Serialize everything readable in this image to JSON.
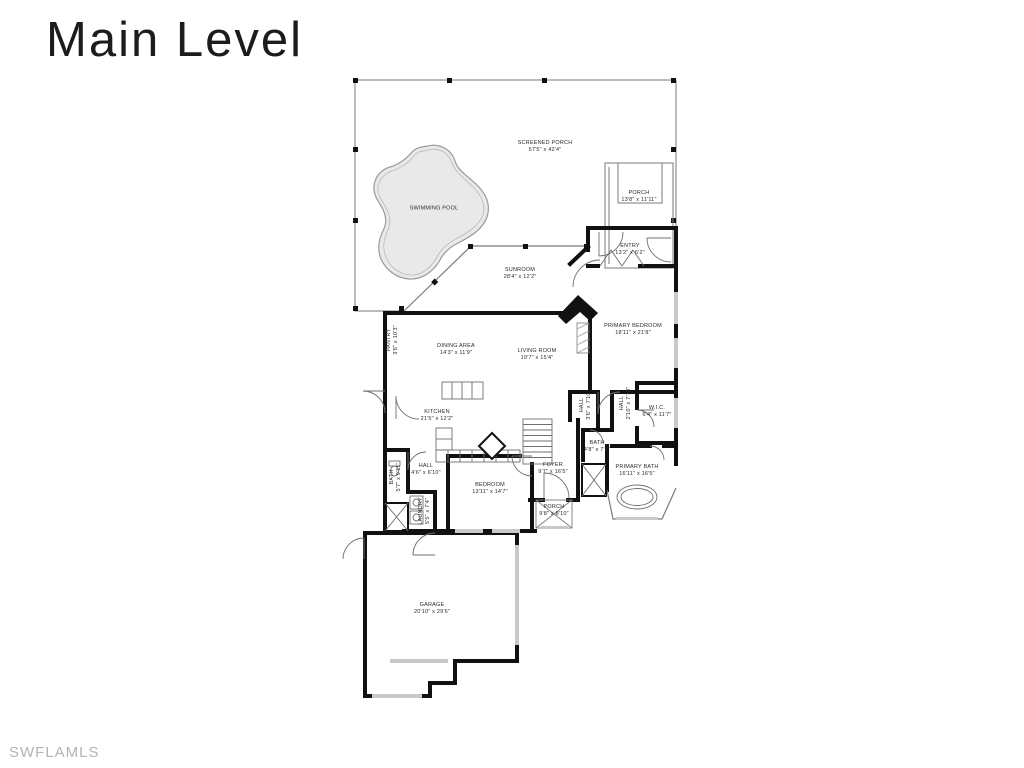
{
  "page": {
    "title": "Main Level",
    "watermark": "SWFLAMLS",
    "background": "#ffffff"
  },
  "plan": {
    "wall_color": "#111111",
    "thin_line_color": "#6f6f6f",
    "pool_fill": "#e9e9e9",
    "pool_outline": "#9a9a9a",
    "window_color": "#c9c9c9",
    "label_color": "#2b2b2b",
    "rooms": [
      {
        "id": "screened-porch",
        "name": "SCREENED PORCH",
        "dims": "57'5\" x 42'4\""
      },
      {
        "id": "swimming-pool",
        "name": "SWIMMING POOL",
        "dims": ""
      },
      {
        "id": "porch-rear",
        "name": "PORCH",
        "dims": "13'8\" x 11'11\""
      },
      {
        "id": "entry",
        "name": "ENTRY",
        "dims": "13'2\" x 6'2\""
      },
      {
        "id": "sunroom",
        "name": "SUNROOM",
        "dims": "28'4\" x 12'2\""
      },
      {
        "id": "primary-bedroom",
        "name": "PRIMARY BEDROOM",
        "dims": "18'11\" x 21'8\""
      },
      {
        "id": "dining-area",
        "name": "DINING AREA",
        "dims": "14'3\" x 11'9\""
      },
      {
        "id": "living-room",
        "name": "LIVING ROOM",
        "dims": "19'7\" x 15'4\""
      },
      {
        "id": "pantry",
        "name": "PANTRY",
        "dims": "3'6\" x 10'3\""
      },
      {
        "id": "kitchen",
        "name": "KITCHEN",
        "dims": "21'5\" x 12'2\""
      },
      {
        "id": "hall-a",
        "name": "HALL",
        "dims": "3'6\" x 7'10\""
      },
      {
        "id": "hall-b",
        "name": "HALL",
        "dims": "2'10\" x 7'10\""
      },
      {
        "id": "wic",
        "name": "W.I.C.",
        "dims": "6'4\" x 11'7\""
      },
      {
        "id": "bath-center",
        "name": "BATH",
        "dims": "4'8\" x 7'7\""
      },
      {
        "id": "foyer",
        "name": "FOYER",
        "dims": "9'7\" x 16'5\""
      },
      {
        "id": "primary-bath",
        "name": "PRIMARY BATH",
        "dims": "16'11\" x 16'5\""
      },
      {
        "id": "bedroom",
        "name": "BEDROOM",
        "dims": "13'11\" x 14'7\""
      },
      {
        "id": "hall-c",
        "name": "HALL",
        "dims": "4'6\" x 6'10\""
      },
      {
        "id": "bath-left",
        "name": "BATH",
        "dims": "5'7\" x 9'11\""
      },
      {
        "id": "laundry",
        "name": "LAUNDRY",
        "dims": "5'5\" x 7'4\""
      },
      {
        "id": "porch-front",
        "name": "PORCH",
        "dims": "9'8\" x 8'10\""
      },
      {
        "id": "garage",
        "name": "GARAGE",
        "dims": "20'10\" x 29'6\""
      }
    ]
  }
}
